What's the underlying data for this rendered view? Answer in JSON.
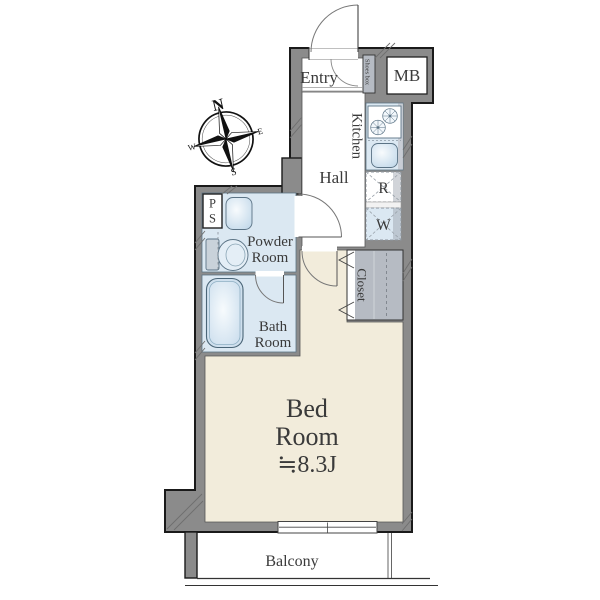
{
  "colors": {
    "wall": "#8b8b8b",
    "outline": "#1a1a1a",
    "bedroom": "#f2ecdb",
    "water": "#dbe8f2",
    "storage": "#b6bbc3",
    "label": "#3a3a3a"
  },
  "rooms": {
    "entry": "Entry",
    "hall": "Hall",
    "kitchen": "Kitchen",
    "powder": {
      "line1": "Powder",
      "line2": "Room"
    },
    "bath": {
      "line1": "Bath",
      "line2": "Room"
    },
    "bedroom": {
      "line1": "Bed",
      "line2": "Room",
      "size": "≒8.3J"
    },
    "closet": "Closet",
    "balcony": "Balcony"
  },
  "features": {
    "shoes_box": "Shoes box",
    "meter_box": "MB",
    "refrigerator": "R",
    "washer": "W",
    "pipe_space": {
      "p": "P",
      "s": "S"
    }
  },
  "compass": {
    "n": "N",
    "e": "E",
    "s": "S",
    "w": "W"
  }
}
